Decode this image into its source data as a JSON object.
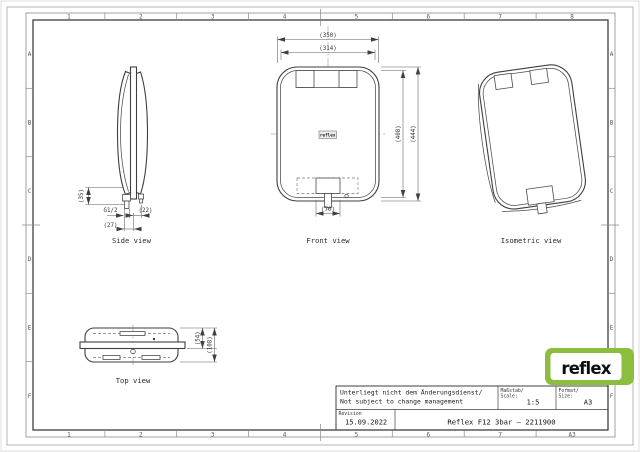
{
  "sheet": {
    "top_ruler": [
      "1",
      "2",
      "3",
      "4",
      "5",
      "6",
      "7",
      "8"
    ],
    "bottom_ruler": [
      "1",
      "2",
      "3",
      "4",
      "5",
      "6",
      "7",
      "A3"
    ],
    "left_ruler": [
      "A",
      "B",
      "C",
      "D",
      "E",
      "F"
    ],
    "right_ruler": [
      "A",
      "B",
      "C",
      "D",
      "E",
      "F"
    ]
  },
  "views": {
    "side": {
      "label": "Side view",
      "dim_35": "(35)",
      "dim_g": "G1/2",
      "dim_22": "(22)",
      "dim_27": "(27)"
    },
    "front": {
      "label": "Front view",
      "badge": "reflex",
      "dim_350": "(350)",
      "dim_314": "(314)",
      "dim_408": "(408)",
      "dim_444": "(444)",
      "dim_70": "(70)"
    },
    "isometric": {
      "label": "Isometric view"
    },
    "top": {
      "label": "Top view",
      "dim_54": "(54)",
      "dim_108": "(108)"
    }
  },
  "title_block": {
    "note_line1": "Unterliegt nicht dem Änderungsdienst/",
    "note_line2": "Not subject to change management",
    "scale_label1": "Maßstab/",
    "scale_label2": "Scale:",
    "scale_value": "1:5",
    "format_label1": "Format/",
    "format_label2": "Size:",
    "format_value": "A3",
    "revision_label": "Revision",
    "revision_date": "15.09.2022",
    "part_title": "Reflex F12 3bar – 2211900"
  },
  "logo": {
    "text": "reflex"
  },
  "colors": {
    "logo_green": "#8cbd3f",
    "line_dark": "#3f3f3f",
    "line_light": "#8a8a8a",
    "paper": "#ffffff"
  }
}
